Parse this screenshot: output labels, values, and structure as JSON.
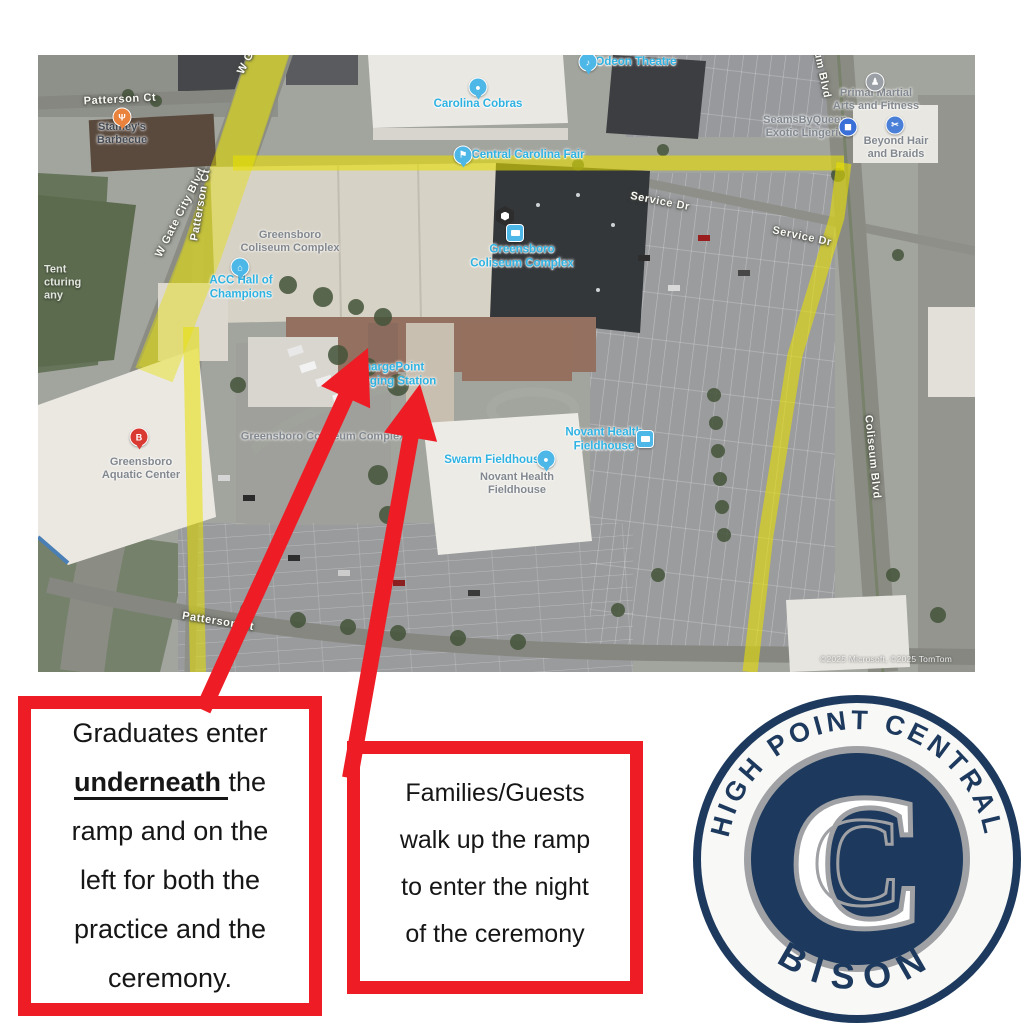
{
  "colors": {
    "annotation_red": "#ee1c24",
    "route_yellow": "#e8e000",
    "logo_navy": "#1d3a5e",
    "logo_silver": "#9fa1a4",
    "poi_blue": "#2eb2e2"
  },
  "boxes": {
    "graduates": {
      "l1": "Graduates enter",
      "l2_emph": "underneath ",
      "l2_rest": "the",
      "l3": "ramp and on the",
      "l4": "left for both the",
      "l5": "practice and the",
      "l6": "ceremony."
    },
    "families": {
      "l1": "Families/Guests",
      "l2": "walk up the ramp",
      "l3": "to enter the night",
      "l4": "of the ceremony"
    }
  },
  "logo": {
    "top_text": "HIGH POINT CENTRAL",
    "bottom_text": "BISON",
    "letter": "C"
  },
  "map": {
    "attribution": "©2025 Microsoft, ©2025 TomTom",
    "labels": [
      {
        "t": "Patterson Ct",
        "x": 82,
        "y": 45,
        "r": -3,
        "k": "road"
      },
      {
        "t": "W Gate City Blvd",
        "x": 143,
        "y": 158,
        "r": -63,
        "k": "road"
      },
      {
        "t": "W Gate City Blvd",
        "x": 225,
        "y": -25,
        "r": -63,
        "k": "road"
      },
      {
        "t": "Patterson Ct",
        "x": 163,
        "y": 150,
        "r": -80,
        "k": "road"
      },
      {
        "t": "Service Dr",
        "x": 622,
        "y": 147,
        "r": 11,
        "k": "road"
      },
      {
        "t": "Service Dr",
        "x": 764,
        "y": 182,
        "r": 12,
        "k": "road"
      },
      {
        "t": "Coliseum Blvd",
        "x": 780,
        "y": 2,
        "r": 78,
        "k": "road"
      },
      {
        "t": "Coliseum Blvd",
        "x": 834,
        "y": 402,
        "r": 84,
        "k": "road"
      },
      {
        "t": "Patterson Ct",
        "x": 180,
        "y": 567,
        "r": 9,
        "k": "road"
      },
      {
        "t": "Carolina Cobras",
        "x": 440,
        "y": 50,
        "r": 0,
        "k": "blue"
      },
      {
        "t": "Central Carolina Fair",
        "x": 490,
        "y": 101,
        "r": 0,
        "k": "blue"
      },
      {
        "t": "Odeon Theatre",
        "x": 598,
        "y": 8,
        "r": 0,
        "k": "blue"
      },
      {
        "t": "ACC Hall of\nChampions",
        "x": 203,
        "y": 233,
        "r": 0,
        "k": "blue"
      },
      {
        "t": "Greensboro\nColiseum Complex",
        "x": 484,
        "y": 202,
        "r": 0,
        "k": "blue"
      },
      {
        "t": "ChargePoint\nCharging Station",
        "x": 352,
        "y": 320,
        "r": 0,
        "k": "blue"
      },
      {
        "t": "Swarm Fieldhouse",
        "x": 457,
        "y": 406,
        "r": 0,
        "k": "blue"
      },
      {
        "t": "Novant Health\nFieldhouse",
        "x": 566,
        "y": 385,
        "r": 0,
        "k": "blue"
      },
      {
        "t": "Greensboro\nColiseum Complex",
        "x": 252,
        "y": 187,
        "r": 0,
        "k": "gray"
      },
      {
        "t": "Greensboro Coliseum Complex",
        "x": 285,
        "y": 382,
        "r": 0,
        "k": "gray"
      },
      {
        "t": "Novant Health\nFieldhouse",
        "x": 479,
        "y": 429,
        "r": 0,
        "k": "gray"
      },
      {
        "t": "Greensboro\nAquatic Center",
        "x": 103,
        "y": 414,
        "r": 0,
        "k": "gray"
      },
      {
        "t": "SeamsByQueen\nExotic Lingerie",
        "x": 767,
        "y": 72,
        "r": 0,
        "k": "gray"
      },
      {
        "t": "Beyond Hair\nand Braids",
        "x": 858,
        "y": 93,
        "r": 0,
        "k": "gray"
      },
      {
        "t": "Primal Martial\nArts and Fitness",
        "x": 838,
        "y": 45,
        "r": 0,
        "k": "gray"
      },
      {
        "t": "Stamey's\nBarbecue",
        "x": 84,
        "y": 79,
        "r": 0,
        "k": "dark"
      },
      {
        "t": "Tent\ncturing\nany",
        "x": 6,
        "y": 228,
        "r": 0,
        "k": "light"
      },
      {
        "t": "©2025 Microsoft, ©2025 TomTom",
        "x": 848,
        "y": 604,
        "r": 0,
        "k": "attrib"
      }
    ],
    "pins": [
      {
        "kind": "restaurant",
        "color": "#e8823c",
        "glyph": "Ψ",
        "x": 84,
        "y": 62,
        "tail": true
      },
      {
        "kind": "sports",
        "color": "#4db8e8",
        "glyph": "●",
        "x": 440,
        "y": 32,
        "tail": true
      },
      {
        "kind": "fair",
        "color": "#4db8e8",
        "glyph": "⚑",
        "x": 425,
        "y": 100,
        "tail": true
      },
      {
        "kind": "theatre",
        "color": "#4db8e8",
        "glyph": "♪",
        "x": 550,
        "y": 7,
        "tail": true
      },
      {
        "kind": "museum",
        "color": "#4db8e8",
        "glyph": "⌂",
        "x": 202,
        "y": 212,
        "tail": true
      },
      {
        "kind": "stadium-hexagon",
        "color": "#2d2d2d",
        "glyph": "",
        "x": 467,
        "y": 161,
        "tail": false
      },
      {
        "kind": "bus-stop",
        "color": "#4db8e8",
        "glyph": "",
        "x": 477,
        "y": 178,
        "tail": false
      },
      {
        "kind": "stadium",
        "color": "#4db8e8",
        "glyph": "●",
        "x": 508,
        "y": 404,
        "tail": true
      },
      {
        "kind": "bus-stop",
        "color": "#4db8e8",
        "glyph": "",
        "x": 607,
        "y": 384,
        "tail": false
      },
      {
        "kind": "letter-b",
        "color": "#d93a32",
        "glyph": "B",
        "x": 101,
        "y": 382,
        "tail": true
      },
      {
        "kind": "shopping",
        "color": "#3a6fd8",
        "glyph": "◼",
        "x": 810,
        "y": 72,
        "tail": false
      },
      {
        "kind": "scissors",
        "color": "#4a7fd8",
        "glyph": "✂",
        "x": 857,
        "y": 70,
        "tail": false
      },
      {
        "kind": "martial-arts",
        "color": "#9aa0a6",
        "glyph": "♟",
        "x": 837,
        "y": 27,
        "tail": false
      }
    ],
    "route": [
      {
        "points": [
          [
            233,
            -8
          ],
          [
            196,
            105
          ],
          [
            163,
            200
          ],
          [
            116,
            320
          ]
        ],
        "width": 40,
        "opacity": 0.42
      },
      {
        "points": [
          [
            195,
            108
          ],
          [
            806,
            108
          ]
        ],
        "width": 15,
        "opacity": 0.6
      },
      {
        "points": [
          [
            806,
            108
          ],
          [
            799,
            162
          ],
          [
            757,
            300
          ],
          [
            728,
            480
          ],
          [
            712,
            617
          ]
        ],
        "width": 15,
        "opacity": 0.6
      },
      {
        "points": [
          [
            153,
            272
          ],
          [
            160,
            617
          ]
        ],
        "width": 16,
        "opacity": 0.55
      }
    ]
  },
  "arrows": [
    {
      "from": [
        203,
        710
      ],
      "to": [
        368,
        348
      ]
    },
    {
      "from": [
        350,
        778
      ],
      "to": [
        420,
        384
      ]
    }
  ]
}
